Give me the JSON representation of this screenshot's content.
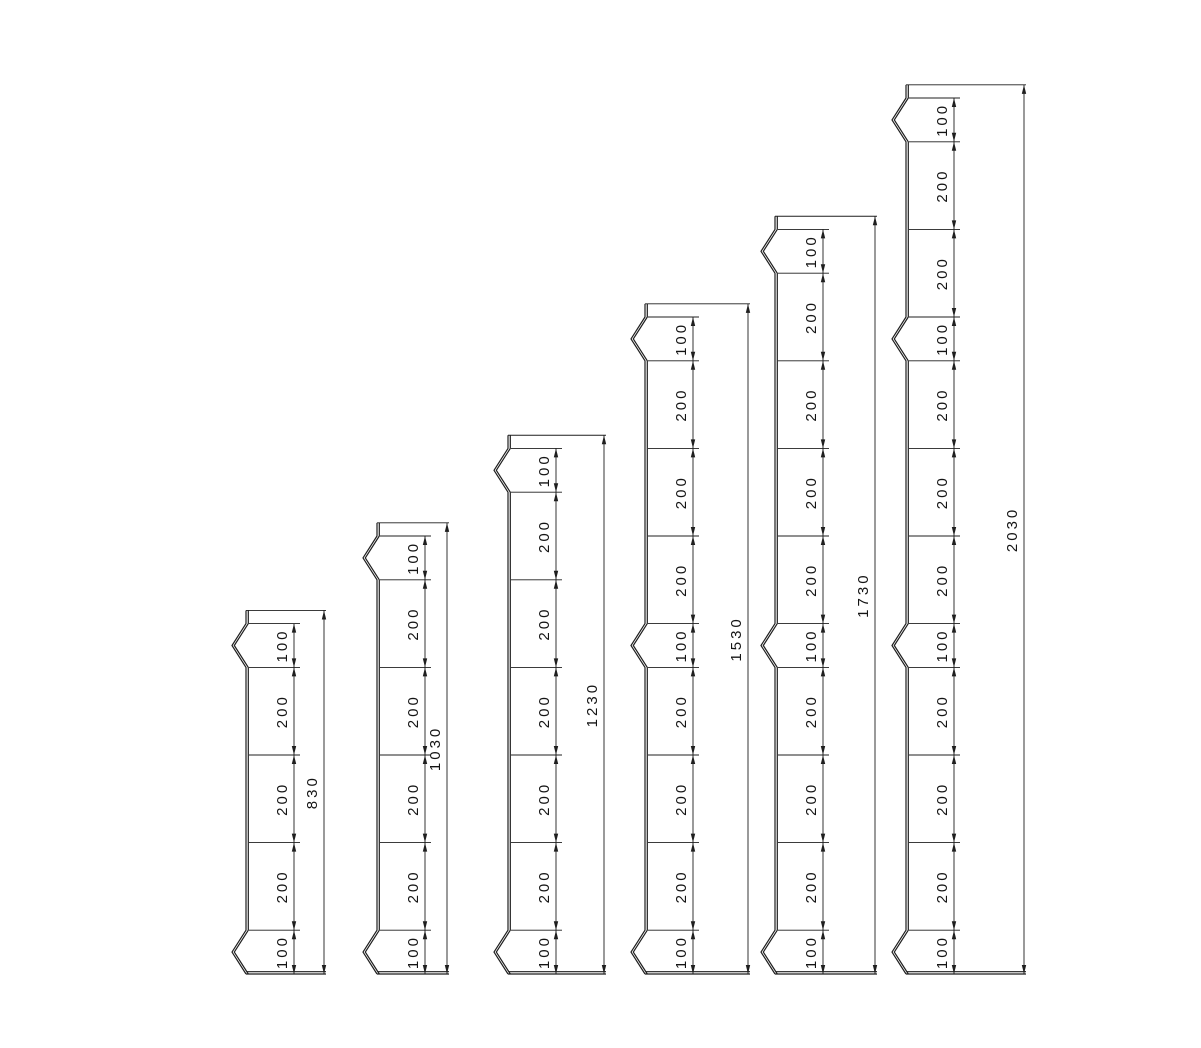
{
  "drawing": {
    "background": "#ffffff",
    "line_color": "#1f1f1f",
    "text_color": "#141414",
    "posts": [
      {
        "name": "post-830",
        "overall": {
          "label": "830",
          "mm": 830
        },
        "segments": [
          {
            "label": "100",
            "mm": 100,
            "notch": true
          },
          {
            "label": "200",
            "mm": 200,
            "notch": false
          },
          {
            "label": "200",
            "mm": 200,
            "notch": false
          },
          {
            "label": "200",
            "mm": 200,
            "notch": false
          },
          {
            "label": "100",
            "mm": 100,
            "notch": true
          }
        ]
      },
      {
        "name": "post-1030",
        "overall": {
          "label": "1030",
          "mm": 1030
        },
        "segments": [
          {
            "label": "100",
            "mm": 100,
            "notch": true
          },
          {
            "label": "200",
            "mm": 200,
            "notch": false
          },
          {
            "label": "200",
            "mm": 200,
            "notch": false
          },
          {
            "label": "200",
            "mm": 200,
            "notch": false
          },
          {
            "label": "200",
            "mm": 200,
            "notch": false
          },
          {
            "label": "100",
            "mm": 100,
            "notch": true
          }
        ]
      },
      {
        "name": "post-1230",
        "overall": {
          "label": "1230",
          "mm": 1230
        },
        "segments": [
          {
            "label": "100",
            "mm": 100,
            "notch": true
          },
          {
            "label": "200",
            "mm": 200,
            "notch": false
          },
          {
            "label": "200",
            "mm": 200,
            "notch": false
          },
          {
            "label": "200",
            "mm": 200,
            "notch": false
          },
          {
            "label": "200",
            "mm": 200,
            "notch": false
          },
          {
            "label": "200",
            "mm": 200,
            "notch": false
          },
          {
            "label": "100",
            "mm": 100,
            "notch": true
          }
        ]
      },
      {
        "name": "post-1530",
        "overall": {
          "label": "1530",
          "mm": 1530
        },
        "segments": [
          {
            "label": "100",
            "mm": 100,
            "notch": true
          },
          {
            "label": "200",
            "mm": 200,
            "notch": false
          },
          {
            "label": "200",
            "mm": 200,
            "notch": false
          },
          {
            "label": "200",
            "mm": 200,
            "notch": false
          },
          {
            "label": "100",
            "mm": 100,
            "notch": true
          },
          {
            "label": "200",
            "mm": 200,
            "notch": false
          },
          {
            "label": "200",
            "mm": 200,
            "notch": false
          },
          {
            "label": "200",
            "mm": 200,
            "notch": false
          },
          {
            "label": "100",
            "mm": 100,
            "notch": true
          }
        ]
      },
      {
        "name": "post-1730",
        "overall": {
          "label": "1730",
          "mm": 1730
        },
        "segments": [
          {
            "label": "100",
            "mm": 100,
            "notch": true
          },
          {
            "label": "200",
            "mm": 200,
            "notch": false
          },
          {
            "label": "200",
            "mm": 200,
            "notch": false
          },
          {
            "label": "200",
            "mm": 200,
            "notch": false
          },
          {
            "label": "200",
            "mm": 200,
            "notch": false
          },
          {
            "label": "100",
            "mm": 100,
            "notch": true
          },
          {
            "label": "200",
            "mm": 200,
            "notch": false
          },
          {
            "label": "200",
            "mm": 200,
            "notch": false
          },
          {
            "label": "200",
            "mm": 200,
            "notch": false
          },
          {
            "label": "100",
            "mm": 100,
            "notch": true
          }
        ]
      },
      {
        "name": "post-2030",
        "overall": {
          "label": "2030",
          "mm": 2030
        },
        "segments": [
          {
            "label": "100",
            "mm": 100,
            "notch": true
          },
          {
            "label": "200",
            "mm": 200,
            "notch": false
          },
          {
            "label": "200",
            "mm": 200,
            "notch": false
          },
          {
            "label": "100",
            "mm": 100,
            "notch": true
          },
          {
            "label": "200",
            "mm": 200,
            "notch": false
          },
          {
            "label": "200",
            "mm": 200,
            "notch": false
          },
          {
            "label": "200",
            "mm": 200,
            "notch": false
          },
          {
            "label": "100",
            "mm": 100,
            "notch": true
          },
          {
            "label": "200",
            "mm": 200,
            "notch": false
          },
          {
            "label": "200",
            "mm": 200,
            "notch": false
          },
          {
            "label": "200",
            "mm": 200,
            "notch": false
          },
          {
            "label": "100",
            "mm": 100,
            "notch": true
          }
        ]
      }
    ]
  }
}
